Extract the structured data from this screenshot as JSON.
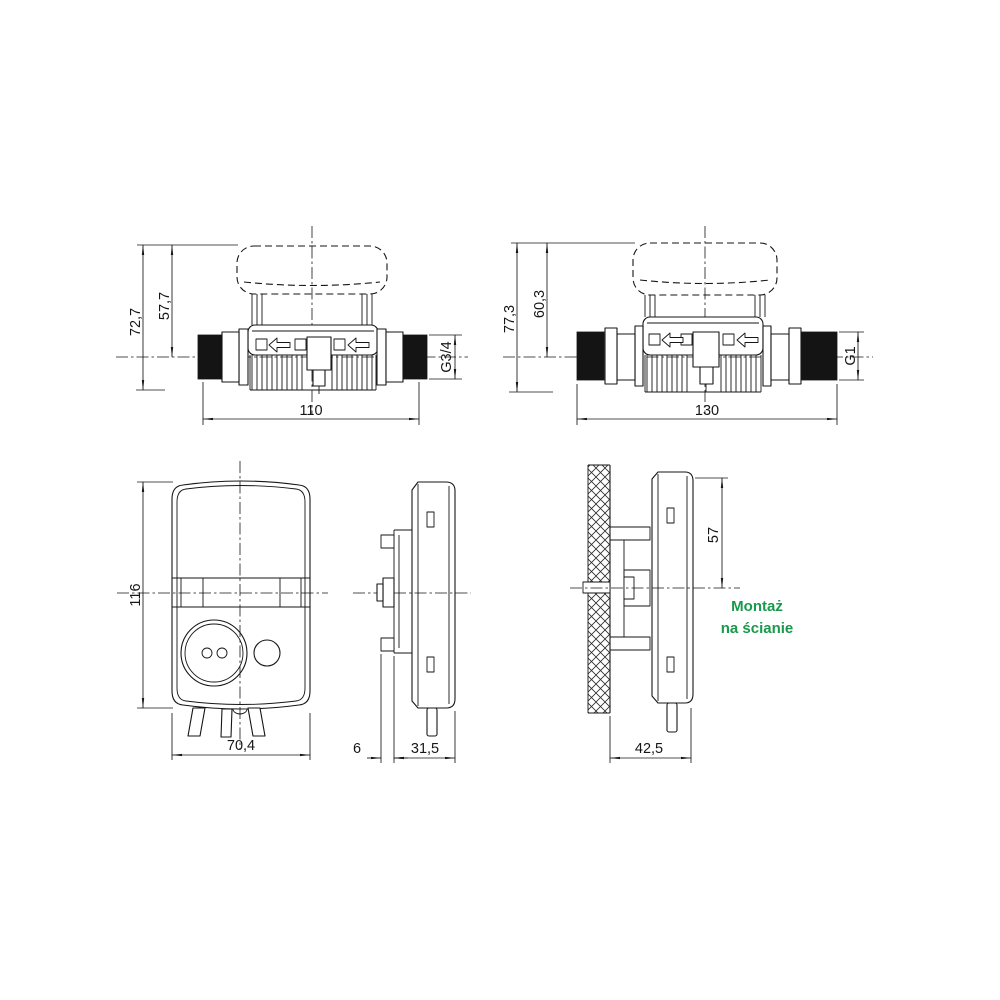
{
  "colors": {
    "line": "#161616",
    "accent_green": "#18994c",
    "background": "#ffffff"
  },
  "views": {
    "meter_g34": {
      "height_total": "72,7",
      "height_to_axis": "57,7",
      "length": "110",
      "thread": "G3/4"
    },
    "meter_g1": {
      "height_total": "77,3",
      "height_to_axis": "60,3",
      "length": "130",
      "thread": "G1"
    },
    "display_front": {
      "height": "116",
      "width": "70,4"
    },
    "display_side": {
      "bracket_depth": "6",
      "depth": "31,5"
    },
    "wall_mount": {
      "top_to_axis": "57",
      "total_depth": "42,5",
      "note_line1": "Montaż",
      "note_line2": "na ścianie"
    }
  }
}
